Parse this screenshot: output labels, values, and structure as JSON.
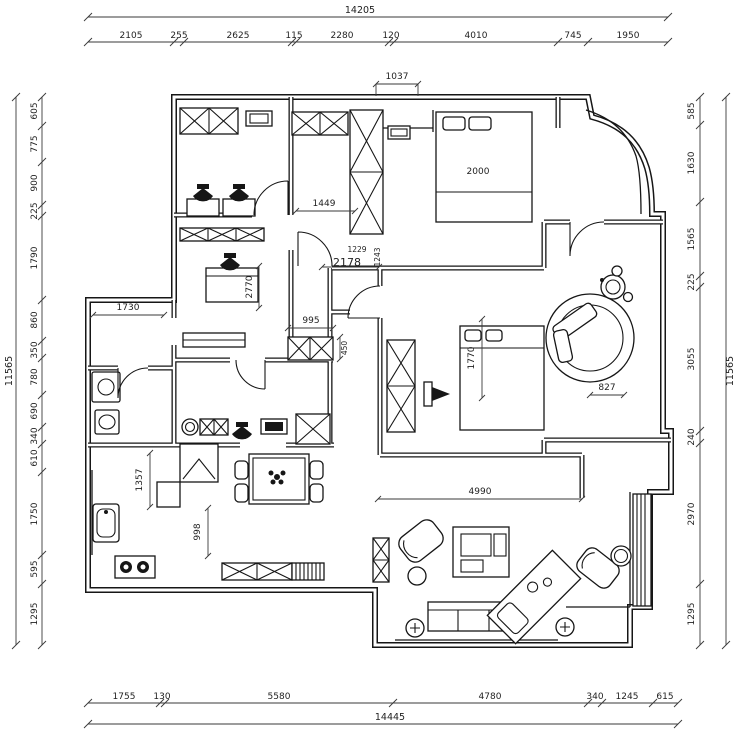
{
  "page": {
    "background": "#ffffff",
    "line_color": "#161616"
  },
  "dimensions": {
    "top": {
      "overall": "14205",
      "segments": [
        "2105",
        "255",
        "2625",
        "115",
        "2280",
        "120",
        "4010",
        "745",
        "1950"
      ]
    },
    "bottom": {
      "overall": "14445",
      "segments": [
        "1755",
        "130",
        "5580",
        "4780",
        "340",
        "1245",
        "615"
      ]
    },
    "left": {
      "overall": "11565",
      "segments": [
        "605",
        "775",
        "900",
        "225",
        "1790",
        "860",
        "350",
        "780",
        "690",
        "340",
        "610",
        "1750",
        "595",
        "1295"
      ]
    },
    "right": {
      "overall": "11565",
      "segments": [
        "585",
        "1630",
        "1565",
        "225",
        "3055",
        "240",
        "2970",
        "1295"
      ]
    },
    "interior": {
      "entry_opening": "1037",
      "master_bed": "2000",
      "hall_width": "1449",
      "master_door_a": "2178",
      "master_door_b": "1229",
      "master_door_c": "1243",
      "study_desk": "2770",
      "hall_left": "1730",
      "cabinet_width": "995",
      "cabinet_depth": "450",
      "bedroom2_bed": "1770",
      "bath_tub": "827",
      "living_width": "4990",
      "kitchen_depth": "1357",
      "kitchen_pass": "998"
    }
  }
}
